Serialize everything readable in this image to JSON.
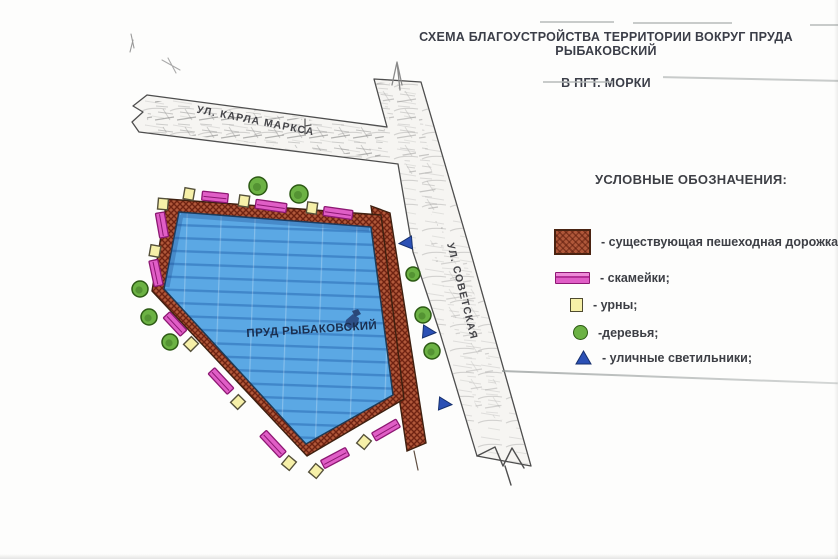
{
  "document": {
    "title_line1": "СХЕМА БЛАГОУСТРОЙСТВА ТЕРРИТОРИИ ВОКРУГ ПРУДА РЫБАКОВСКИЙ",
    "title_line2": "В ПГТ. МОРКИ"
  },
  "map": {
    "pond_label": "ПРУД РЫБАКОВСКИЙ",
    "street_1": "УЛ. КАРЛА МАРКСА",
    "street_2": "УЛ. СОВЕТСКАЯ",
    "symbols": {
      "benches": [
        {
          "x": 215,
          "y": 197,
          "rot": 6,
          "w": 26
        },
        {
          "x": 271,
          "y": 206,
          "rot": 8,
          "w": 31
        },
        {
          "x": 338,
          "y": 213,
          "rot": 8,
          "w": 29
        },
        {
          "x": 162,
          "y": 225,
          "rot": 80,
          "w": 25
        },
        {
          "x": 156,
          "y": 273,
          "rot": 78,
          "w": 26
        },
        {
          "x": 175,
          "y": 324,
          "rot": 47,
          "w": 25
        },
        {
          "x": 221,
          "y": 381,
          "rot": 47,
          "w": 28
        },
        {
          "x": 273,
          "y": 444,
          "rot": 47,
          "w": 29
        },
        {
          "x": 335,
          "y": 458,
          "rot": -28,
          "w": 28
        },
        {
          "x": 386,
          "y": 430,
          "rot": -30,
          "w": 28
        }
      ],
      "urns": [
        {
          "x": 189,
          "y": 194,
          "rot": 10
        },
        {
          "x": 163,
          "y": 204,
          "rot": 5
        },
        {
          "x": 244,
          "y": 201,
          "rot": 8
        },
        {
          "x": 312,
          "y": 208,
          "rot": 8
        },
        {
          "x": 155,
          "y": 251,
          "rot": 10
        },
        {
          "x": 191,
          "y": 344,
          "rot": 45
        },
        {
          "x": 238,
          "y": 402,
          "rot": 45
        },
        {
          "x": 289,
          "y": 463,
          "rot": 40
        },
        {
          "x": 316,
          "y": 471,
          "rot": 40
        },
        {
          "x": 364,
          "y": 442,
          "rot": 40
        }
      ],
      "trees": [
        {
          "x": 258,
          "y": 186,
          "r": 9
        },
        {
          "x": 299,
          "y": 194,
          "r": 9
        },
        {
          "x": 140,
          "y": 289,
          "r": 8
        },
        {
          "x": 149,
          "y": 317,
          "r": 8
        },
        {
          "x": 170,
          "y": 342,
          "r": 8
        },
        {
          "x": 413,
          "y": 274,
          "r": 7
        },
        {
          "x": 423,
          "y": 315,
          "r": 8
        },
        {
          "x": 432,
          "y": 351,
          "r": 8
        },
        {
          "x": 445,
          "y": 404,
          "r": 0
        }
      ],
      "lights": [
        {
          "x": 406,
          "y": 243,
          "rot": -95
        },
        {
          "x": 429,
          "y": 332,
          "rot": 95
        },
        {
          "x": 445,
          "y": 404,
          "rot": 95
        }
      ]
    }
  },
  "legend": {
    "title": "УСЛОВНЫЕ ОБОЗНАЧЕНИЯ:",
    "items": [
      {
        "icon": "path-swatch",
        "label": "- существующая пешеходная дорожка;"
      },
      {
        "icon": "bench-swatch",
        "label": "- скамейки;"
      },
      {
        "icon": "urn-swatch",
        "label": "- урны;"
      },
      {
        "icon": "tree-swatch",
        "label": "-деревья;"
      },
      {
        "icon": "light-swatch",
        "label": "- уличные светильники;"
      }
    ]
  },
  "colors": {
    "path_brown": "#b0583a",
    "path_hatch": "#6f2312",
    "path_border": "#3f2010",
    "pond_blue": "#5ba8e4",
    "pond_border": "#1f3a55",
    "bench_pink": "#e05ec6",
    "bench_border": "#8d1873",
    "urn_yellow": "#f6f0a8",
    "urn_border": "#55513a",
    "tree_green": "#6cb244",
    "tree_border": "#2c5a14",
    "light_blue": "#2b50b5",
    "light_border": "#16306e",
    "road_fill": "#f6f5f2",
    "road_border": "#4d4d4d",
    "text_dark": "#3b3e48",
    "pond_text": "#1a2e4f"
  }
}
